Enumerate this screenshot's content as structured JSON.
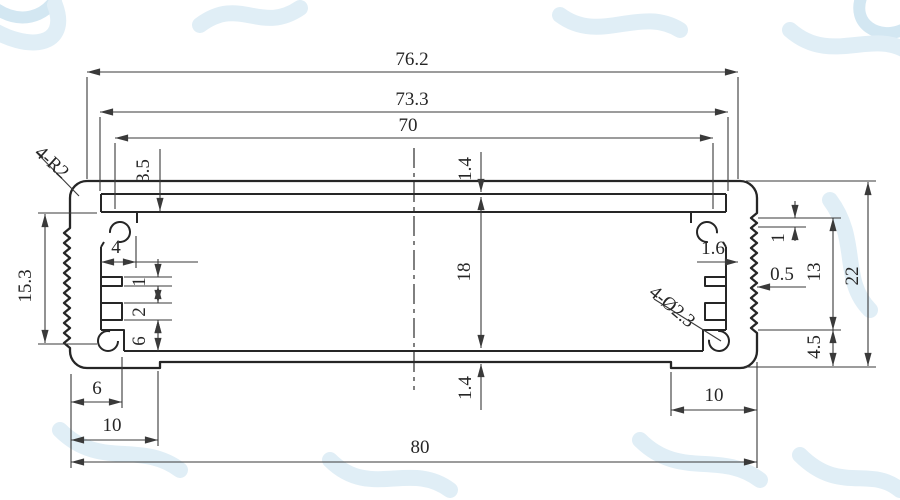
{
  "drawing": {
    "dims": {
      "top_face_width": "76.2",
      "groove_outer_width": "73.3",
      "groove_opening_width": "70",
      "top_step_depth": "3.5",
      "top_wall_thickness": "1.4",
      "cavity_height": "18",
      "bottom_wall_thickness": "1.4",
      "left_knurl_height": "15.3",
      "boss_width": "4",
      "rib_thickness": "1",
      "slot_height": "2",
      "slot_to_floor": "6",
      "left_foot_width": "6",
      "left_step_offset": "10",
      "overall_width": "80",
      "right_step_offset": "10",
      "right_wall_thickness": "1.6",
      "knurl_depth": "0.5",
      "right_rib_offset": "1",
      "right_knurl_height": "13",
      "overall_height": "22",
      "right_corner_height": "4.5"
    },
    "labels": {
      "corner_radius": "4-R2",
      "screw_holes": "4-Ø2.3"
    },
    "colors": {
      "ink": "#262626",
      "dim_ink": "#3a3a3a",
      "paper": "#ffffff",
      "watermark": "#e0eef6"
    }
  }
}
